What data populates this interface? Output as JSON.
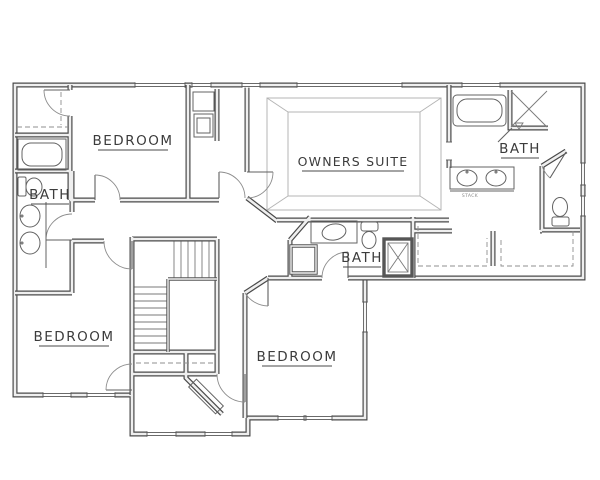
{
  "plan": {
    "labels": {
      "bedroom_top_left": "BEDROOM",
      "bedroom_bottom_left": "BEDROOM",
      "bedroom_bottom_center": "BEDROOM",
      "owners_suite": "OWNERS SUITE",
      "bath_left": "BATH",
      "bath_center": "BATH",
      "bath_owners": "BATH",
      "vanity_note": "STACK"
    },
    "colors": {
      "background": "#ffffff",
      "wall_line": "#4a4a4a",
      "wall_fill": "#efefef",
      "thin_line": "#636363",
      "label_text": "#3c3c3c"
    }
  }
}
